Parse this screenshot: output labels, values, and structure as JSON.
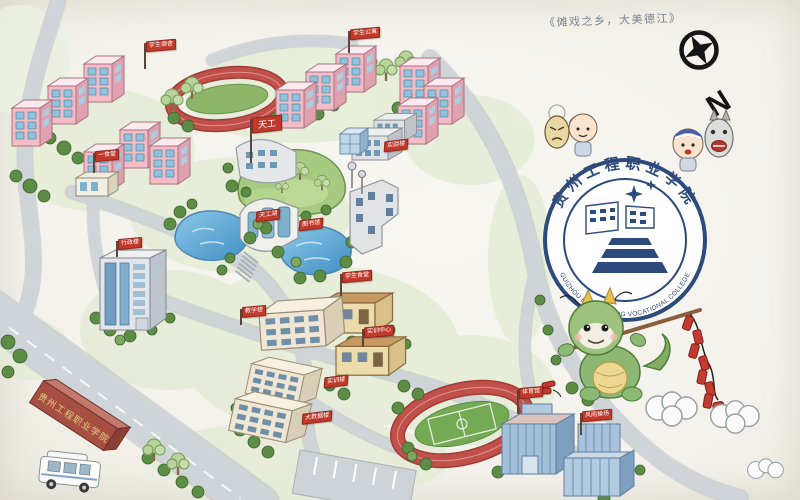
{
  "caption": "《傩戏之乡，大美德江》",
  "compass": {
    "label": "N"
  },
  "logo": {
    "name_cn": "贵州工程职业学院",
    "name_en": "GUIZHOU ENGINEERING VOCATIONAL COLLEGE"
  },
  "entrance_monument": {
    "text": "贵州工程职业学院"
  },
  "flags": [
    {
      "label": "学生宿舍",
      "x": 146,
      "y": 40,
      "type": "flag",
      "pole": 26
    },
    {
      "label": "学生公寓",
      "x": 350,
      "y": 28,
      "type": "flag",
      "pole": 22
    },
    {
      "label": "一食堂",
      "x": 95,
      "y": 150,
      "type": "flag",
      "pole": 20
    },
    {
      "label": "实验楼",
      "x": 384,
      "y": 140,
      "type": "sign"
    },
    {
      "label": "天工",
      "x": 252,
      "y": 116,
      "type": "bigflag",
      "pole": 44
    },
    {
      "label": "天工湖",
      "x": 256,
      "y": 210,
      "type": "sign"
    },
    {
      "label": "图书馆",
      "x": 299,
      "y": 219,
      "type": "sign"
    },
    {
      "label": "行政楼",
      "x": 118,
      "y": 238,
      "type": "flag",
      "pole": 16
    },
    {
      "label": "学生食堂",
      "x": 342,
      "y": 271,
      "type": "flag",
      "pole": 22
    },
    {
      "label": "教学楼",
      "x": 242,
      "y": 306,
      "type": "flag",
      "pole": 16
    },
    {
      "label": "实训中心",
      "x": 364,
      "y": 326,
      "type": "flag",
      "pole": 18
    },
    {
      "label": "实训楼",
      "x": 324,
      "y": 376,
      "type": "sign"
    },
    {
      "label": "大数据楼",
      "x": 302,
      "y": 412,
      "type": "sign"
    },
    {
      "label": "体育馆",
      "x": 519,
      "y": 387,
      "type": "flag",
      "pole": 24
    },
    {
      "label": "风雨操场",
      "x": 582,
      "y": 410,
      "type": "flag",
      "pole": 22
    }
  ],
  "colors": {
    "flag_red": "#c0392b",
    "logo_blue": "#2c4a7c",
    "track_red": "#c1504a",
    "pond_blue": "#5aa7d8",
    "grass_green": "#9cc47a",
    "road_grey": "#cfd4d9",
    "building_pink": "#f4bcc7"
  }
}
